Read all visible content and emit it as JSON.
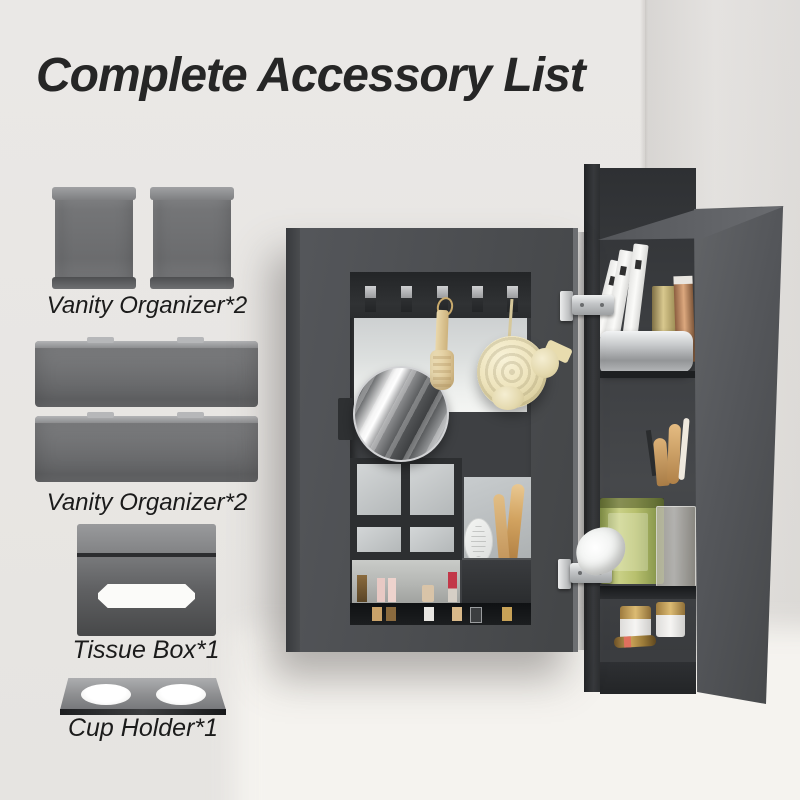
{
  "title": "Complete Accessory List",
  "accessory_list": {
    "items": [
      {
        "id": "vanity-organizer-boxes",
        "label": "Vanity Organizer*2"
      },
      {
        "id": "vanity-organizer-trays",
        "label": "Vanity Organizer*2"
      },
      {
        "id": "tissue-box",
        "label": "Tissue Box*1"
      },
      {
        "id": "cup-holder",
        "label": "Cup Holder*1"
      }
    ]
  },
  "colors": {
    "wall": "#e9e7e4",
    "wall_shaded": "#dcdad7",
    "wall_lower_highlight": "#f4f2ef",
    "cabinet_gray": "#4c4e51",
    "cabinet_interior_dark": "#2f3134",
    "accessory_gray": "#737476",
    "title_text": "#262626",
    "label_text": "#1b1b1b",
    "loofah_cream": "#eee4bd",
    "wood_brush_tan": "#d9bf8c",
    "tissue_box_green": "#b8c06e",
    "lipstick_red": "#c23748",
    "gold_accent": "#c8a257"
  }
}
